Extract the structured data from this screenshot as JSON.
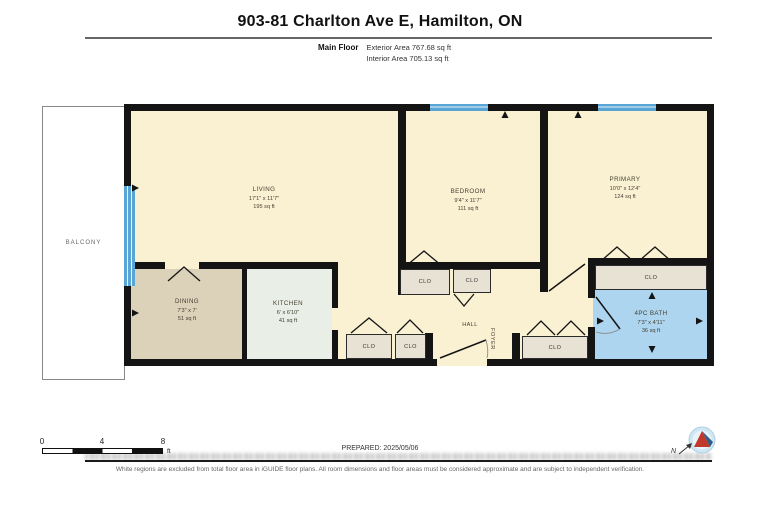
{
  "header": {
    "title": "903-81 Charlton Ave E, Hamilton, ON",
    "floor_label": "Main Floor",
    "exterior_area": "Exterior Area 767.68 sq ft",
    "interior_area": "Interior Area 705.13 sq ft"
  },
  "rooms": {
    "balcony": "BALCONY",
    "living": {
      "name": "LIVING",
      "dims": "17'1\" x 11'7\"",
      "area": "195 sq ft"
    },
    "dining": {
      "name": "DINING",
      "dims": "7'3\" x 7'",
      "area": "51 sq ft"
    },
    "kitchen": {
      "name": "KITCHEN",
      "dims": "6' x 6'10\"",
      "area": "41 sq ft"
    },
    "bedroom": {
      "name": "BEDROOM",
      "dims": "9'4\" x 11'7\"",
      "area": "111 sq ft"
    },
    "primary": {
      "name": "PRIMARY",
      "dims": "10'0\" x 12'4\"",
      "area": "124 sq ft"
    },
    "bath": {
      "name": "4PC BATH",
      "dims": "7'3\" x 4'11\"",
      "area": "36 sq ft"
    },
    "hall": "HALL",
    "foyer": "FOYER",
    "closet": "CLO"
  },
  "scale_bar": {
    "ticks": [
      "0",
      "4",
      "8"
    ],
    "unit": "ft"
  },
  "footer": {
    "prepared": "PREPARED: 2025/05/06",
    "disclaimer": "White regions are excluded from total floor area in iGUIDE floor plans. All room dimensions and floor areas must be considered approximate and are subject to independent verification.",
    "compass_label": "N"
  },
  "colors": {
    "wall": "#141414",
    "room_cream": "#FAF1D3",
    "dining_tan": "#DCD2BA",
    "kitchen_green": "#E9EFE6",
    "bath_blue": "#ADD5EF",
    "closet_gray": "#E8E2D4",
    "window_blue": "#58A5D6"
  }
}
